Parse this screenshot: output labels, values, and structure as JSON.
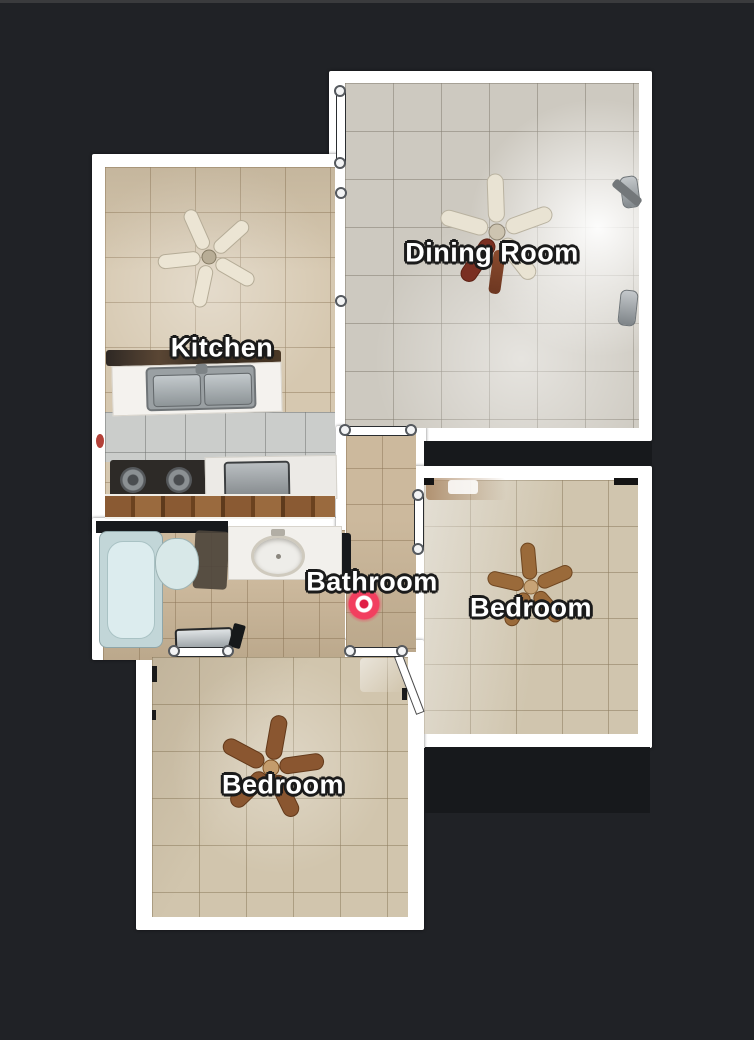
{
  "colors": {
    "background": "#202226",
    "wall": "#ffffff",
    "puck": "#f23f5f",
    "label_text": "#ffffff",
    "label_outline": "#1b1b1b"
  },
  "rooms": [
    {
      "id": "dining-room",
      "label": "Dining Room",
      "has_ceiling_fan": true
    },
    {
      "id": "kitchen",
      "label": "Kitchen",
      "has_ceiling_fan": true
    },
    {
      "id": "bathroom",
      "label": "Bathroom",
      "has_ceiling_fan": false
    },
    {
      "id": "bedroom-right",
      "label": "Bedroom",
      "has_ceiling_fan": true
    },
    {
      "id": "bedroom-bottom",
      "label": "Bedroom",
      "has_ceiling_fan": true
    }
  ],
  "marker": {
    "type": "camera-location-puck"
  },
  "icons": {
    "ceiling_fan": "fan-blades-top-view",
    "door": "door-opening-marker",
    "wall_node": "wall-junction-node"
  }
}
